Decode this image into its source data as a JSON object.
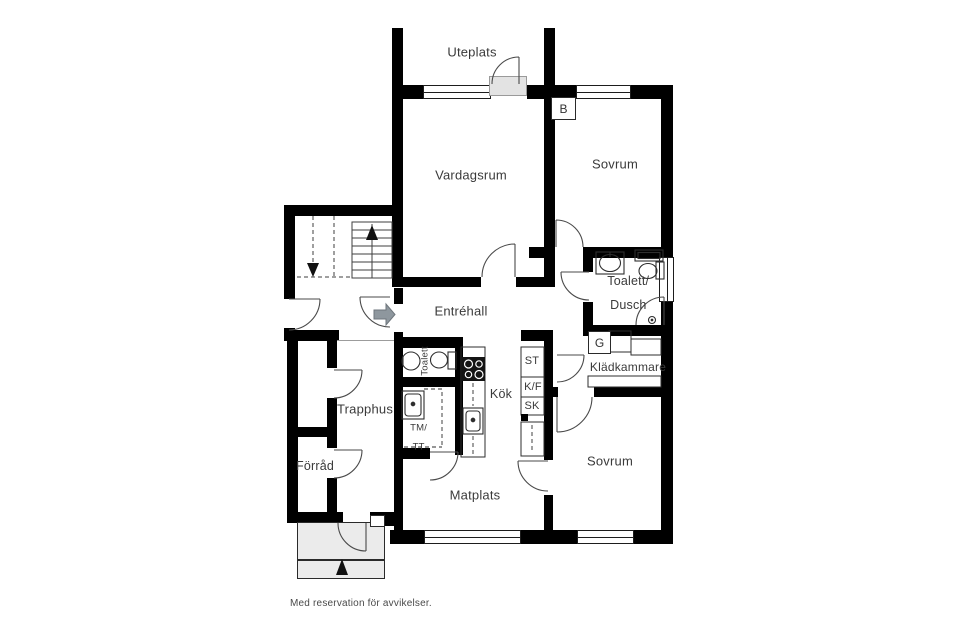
{
  "plan": {
    "rooms": {
      "uteplats": "Uteplats",
      "vardagsrum": "Vardagsrum",
      "sovrum_top": "Sovrum",
      "toalett_dusch_line1": "Toalett/",
      "toalett_dusch_line2": "Dusch",
      "kladkammare": "Klädkammare",
      "kok": "Kök",
      "toalett": "Toalett",
      "trapphus": "Trapphus",
      "forrad": "Förråd",
      "entrehall": "Entréhall",
      "matplats": "Matplats",
      "sovrum_bottom": "Sovrum"
    },
    "markers": {
      "balcony_door": "B",
      "wardrobe": "G",
      "tall_cabinet": "ST",
      "fridge_freezer": "K/F",
      "cabinet": "SK",
      "washer_line1": "TM/",
      "washer_line2": "TT"
    },
    "disclaimer": "Med reservation för avvikelser.",
    "colors": {
      "wall": "#000000",
      "background": "#ffffff",
      "porch_fill": "#ebebeb",
      "threshold_fill": "#e3e3e3",
      "entry_arrow": "#8e979e",
      "text": "#3a3a3a"
    }
  }
}
